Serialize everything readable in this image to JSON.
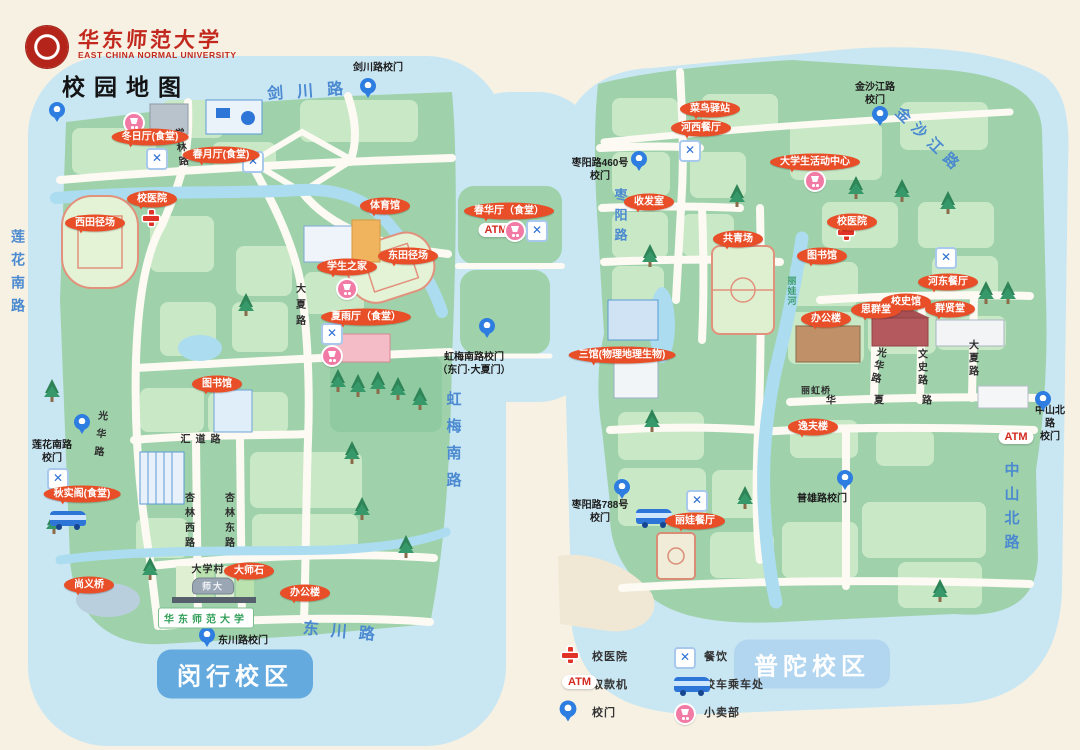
{
  "header": {
    "university_cn": "华东师范大学",
    "university_en": "EAST CHINA NORMAL UNIVERSITY",
    "map_title": "校园地图"
  },
  "colors": {
    "background": "#f6f1e3",
    "water": "#c9e6f3",
    "land_green": "#9fd2ab",
    "block_green": "#c9e8c6",
    "poi_red": "#e84f28",
    "pin_blue": "#2e7de0",
    "road_label_blue": "#4b8ad0",
    "badge_minhang_blue": "#64aadf",
    "badge_putuo_blue": "#b2d6ef"
  },
  "legend": {
    "atm_text": "ATM",
    "items": [
      {
        "icon": "hospital-cross",
        "label": "校医院"
      },
      {
        "icon": "dining",
        "label": "餐饮"
      },
      {
        "icon": "atm",
        "label": "取款机"
      },
      {
        "icon": "bus",
        "label": "校车乘车处"
      },
      {
        "icon": "gate-pin",
        "label": "校门"
      },
      {
        "icon": "shop",
        "label": "小卖部"
      }
    ]
  },
  "map": {
    "pois": [
      {
        "text": "冬日厅(食堂)",
        "x": 150,
        "y": 137
      },
      {
        "text": "春月厅(食堂)",
        "x": 221,
        "y": 155
      },
      {
        "text": "校医院",
        "x": 152,
        "y": 199
      },
      {
        "text": "西田径场",
        "x": 95,
        "y": 223
      },
      {
        "text": "体育馆",
        "x": 385,
        "y": 206
      },
      {
        "text": "东田径场",
        "x": 408,
        "y": 256
      },
      {
        "text": "学生之家",
        "x": 347,
        "y": 267
      },
      {
        "text": "夏雨厅（食堂）",
        "x": 366,
        "y": 317
      },
      {
        "text": "图书馆",
        "x": 217,
        "y": 384
      },
      {
        "text": "秋实阁(食堂)",
        "x": 82,
        "y": 494
      },
      {
        "text": "尚义桥",
        "x": 89,
        "y": 585
      },
      {
        "text": "大师石",
        "x": 249,
        "y": 571
      },
      {
        "text": "办公楼",
        "x": 305,
        "y": 593
      },
      {
        "text": "春华厅（食堂）",
        "x": 509,
        "y": 211
      },
      {
        "text": "菜鸟驿站",
        "x": 710,
        "y": 109
      },
      {
        "text": "河西餐厅",
        "x": 701,
        "y": 128
      },
      {
        "text": "大学生活动中心",
        "x": 815,
        "y": 162
      },
      {
        "text": "收发室",
        "x": 649,
        "y": 202
      },
      {
        "text": "校医院",
        "x": 852,
        "y": 222
      },
      {
        "text": "共青场",
        "x": 738,
        "y": 239
      },
      {
        "text": "图书馆",
        "x": 822,
        "y": 256
      },
      {
        "text": "河东餐厅",
        "x": 948,
        "y": 282
      },
      {
        "text": "校史馆",
        "x": 906,
        "y": 302
      },
      {
        "text": "思群堂",
        "x": 876,
        "y": 310
      },
      {
        "text": "群贤堂",
        "x": 950,
        "y": 309
      },
      {
        "text": "办公楼",
        "x": 826,
        "y": 319
      },
      {
        "text": "三馆(物理地理生物)",
        "x": 622,
        "y": 355
      },
      {
        "text": "逸夫楼",
        "x": 813,
        "y": 427
      },
      {
        "text": "丽娃餐厅",
        "x": 695,
        "y": 521
      }
    ],
    "gates": [
      {
        "text": "剑川路校门",
        "x": 378,
        "y": 68
      },
      {
        "text": "莲花南路\n校门",
        "x": 52,
        "y": 452
      },
      {
        "text": "虹梅南路校门\n（东门·大夏门）",
        "x": 474,
        "y": 364
      },
      {
        "text": "东川路校门",
        "x": 243,
        "y": 641
      },
      {
        "text": "枣阳路460号\n校门",
        "x": 600,
        "y": 170
      },
      {
        "text": "金沙江路\n校门",
        "x": 875,
        "y": 94
      },
      {
        "text": "中山北路\n校门",
        "x": 1050,
        "y": 424
      },
      {
        "text": "枣阳路788号\n校门",
        "x": 600,
        "y": 512
      },
      {
        "text": "普雄路校门",
        "x": 822,
        "y": 499
      }
    ],
    "pins": [
      {
        "x": 57,
        "y": 113
      },
      {
        "x": 368,
        "y": 89
      },
      {
        "x": 82,
        "y": 425
      },
      {
        "x": 487,
        "y": 329
      },
      {
        "x": 207,
        "y": 638
      },
      {
        "x": 639,
        "y": 162
      },
      {
        "x": 880,
        "y": 117
      },
      {
        "x": 1043,
        "y": 402
      },
      {
        "x": 622,
        "y": 490
      },
      {
        "x": 845,
        "y": 481
      }
    ],
    "roads": [
      {
        "text": "剑川路",
        "x": 312,
        "y": 89,
        "rot": -4,
        "ls": 14,
        "size": 16
      },
      {
        "text": "莲花南路",
        "x": 18,
        "y": 275,
        "v": 1,
        "ls": 9,
        "size": 14
      },
      {
        "text": "虹梅南路",
        "x": 453,
        "y": 445,
        "v": 1,
        "ls": 12,
        "size": 15
      },
      {
        "text": "东川路",
        "x": 345,
        "y": 630,
        "rot": 5,
        "ls": 12,
        "size": 16
      },
      {
        "text": "金沙江路",
        "x": 930,
        "y": 140,
        "rot": 44,
        "ls": 7,
        "size": 15
      },
      {
        "text": "中山北路",
        "x": 1011,
        "y": 510,
        "v": 1,
        "ls": 9,
        "size": 15
      },
      {
        "text": "枣阳路",
        "x": 620,
        "y": 218,
        "v": 1,
        "ls": 7,
        "size": 13
      },
      {
        "text": "学林路",
        "x": 180,
        "y": 149,
        "v": 1,
        "k": 1,
        "ls": 4,
        "size": 10,
        "rot": -8
      },
      {
        "text": "大夏路",
        "x": 299,
        "y": 307,
        "v": 1,
        "k": 1,
        "ls": 6,
        "size": 10
      },
      {
        "text": "光华路",
        "x": 99,
        "y": 437,
        "v": 1,
        "k": 1,
        "ls": 8,
        "size": 10,
        "rot": 6
      },
      {
        "text": "汇道路",
        "x": 203,
        "y": 438,
        "k": 1,
        "ls": 5,
        "size": 10
      },
      {
        "text": "杏林西路",
        "x": 188,
        "y": 522,
        "v": 1,
        "k": 1,
        "ls": 5,
        "size": 10
      },
      {
        "text": "杏林东路",
        "x": 228,
        "y": 522,
        "v": 1,
        "k": 1,
        "ls": 5,
        "size": 10
      },
      {
        "text": "光华路",
        "x": 877,
        "y": 366,
        "v": 1,
        "k": 1,
        "ls": 3,
        "size": 10,
        "rot": 12
      },
      {
        "text": "文史路",
        "x": 921,
        "y": 368,
        "v": 1,
        "k": 1,
        "ls": 3,
        "size": 10
      },
      {
        "text": "大夏路",
        "x": 972,
        "y": 359,
        "v": 1,
        "k": 1,
        "ls": 3,
        "size": 10
      },
      {
        "text": "华夏路",
        "x": 898,
        "y": 399,
        "k": 1,
        "ls": 38,
        "size": 10
      },
      {
        "text": "丽虹桥",
        "x": 816,
        "y": 390,
        "k": 1,
        "ls": 1,
        "size": 9
      },
      {
        "text": "大学村",
        "x": 208,
        "y": 568,
        "k": 1,
        "ls": 1,
        "size": 10
      },
      {
        "text": "丽娃河",
        "x": 792,
        "y": 291,
        "v": 1,
        "ls": 1,
        "size": 9,
        "color": "#3f9e6c"
      }
    ],
    "icons": [
      {
        "type": "shop",
        "x": 134,
        "y": 123
      },
      {
        "type": "dining",
        "x": 157,
        "y": 159
      },
      {
        "type": "dining",
        "x": 253,
        "y": 162
      },
      {
        "type": "cross",
        "x": 151,
        "y": 218
      },
      {
        "type": "shop",
        "x": 347,
        "y": 289
      },
      {
        "type": "dining",
        "x": 332,
        "y": 334
      },
      {
        "type": "shop",
        "x": 332,
        "y": 356
      },
      {
        "type": "dining",
        "x": 58,
        "y": 479
      },
      {
        "type": "bus",
        "x": 68,
        "y": 520
      },
      {
        "type": "atm",
        "x": 496,
        "y": 230,
        "label": "ATM"
      },
      {
        "type": "shop",
        "x": 515,
        "y": 231
      },
      {
        "type": "dining",
        "x": 537,
        "y": 231
      },
      {
        "type": "dining",
        "x": 690,
        "y": 151
      },
      {
        "type": "shop",
        "x": 815,
        "y": 181
      },
      {
        "type": "cross",
        "x": 846,
        "y": 232
      },
      {
        "type": "dining",
        "x": 946,
        "y": 258
      },
      {
        "type": "dining",
        "x": 697,
        "y": 501
      },
      {
        "type": "bus",
        "x": 654,
        "y": 518
      },
      {
        "type": "atm",
        "x": 1016,
        "y": 437,
        "label": "ATM"
      }
    ],
    "signs": [
      {
        "type": "gate-sign",
        "name": "minhang-gate-sign",
        "text": "华东师范大学",
        "x": 206,
        "y": 618
      },
      {
        "type": "stone",
        "name": "shida-stone",
        "text": "师大",
        "x": 213,
        "y": 586
      },
      {
        "type": "badge badge-minhang",
        "name": "campus-badge-minhang",
        "text": "闵行校区",
        "x": 235,
        "y": 674
      },
      {
        "type": "badge badge-putuo",
        "name": "campus-badge-putuo",
        "text": "普陀校区",
        "x": 812,
        "y": 664
      }
    ]
  }
}
